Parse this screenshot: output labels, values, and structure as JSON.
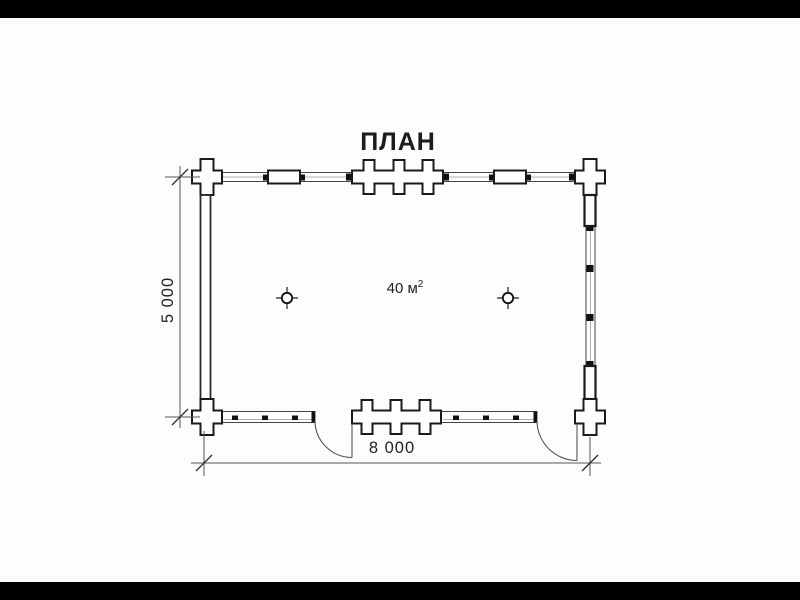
{
  "title": "ПЛАН",
  "plan": {
    "area_label": {
      "text": "40 м",
      "superscript": "2"
    },
    "dimensions": {
      "width": "8 000",
      "height": "5 000"
    }
  },
  "colors": {
    "wall_line": "#1a1a1a",
    "thin_line": "#555555",
    "background": "#ffffff",
    "letterbox": "#000000"
  }
}
